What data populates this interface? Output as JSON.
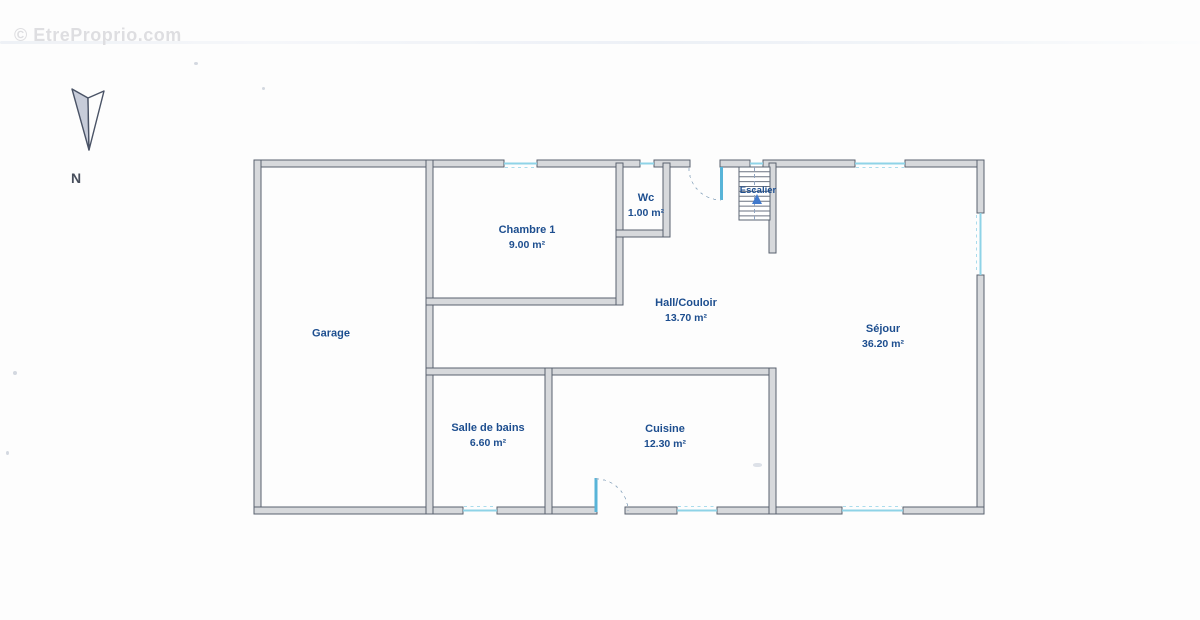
{
  "watermark": {
    "text": "© EtreProprio.com"
  },
  "compass": {
    "label": "N"
  },
  "plan": {
    "colors": {
      "wall_stroke": "#59616e",
      "wall_fill": "#d7d9dc",
      "window": "#8ed3e7",
      "door": "#58b4d8",
      "room_label": "#1d4e8f"
    },
    "rooms": [
      {
        "id": "garage",
        "name": "Garage",
        "area": ""
      },
      {
        "id": "chambre-1",
        "name": "Chambre 1",
        "area": "9.00 m²"
      },
      {
        "id": "wc",
        "name": "Wc",
        "area": "1.00 m²"
      },
      {
        "id": "hall-couloir",
        "name": "Hall/Couloir",
        "area": "13.70 m²"
      },
      {
        "id": "escalier",
        "name": "Escalier",
        "area": ""
      },
      {
        "id": "sejour",
        "name": "Séjour",
        "area": "36.20 m²"
      },
      {
        "id": "salle-de-bains",
        "name": "Salle de bains",
        "area": "6.60 m²"
      },
      {
        "id": "cuisine",
        "name": "Cuisine",
        "area": "12.30 m²"
      }
    ]
  }
}
